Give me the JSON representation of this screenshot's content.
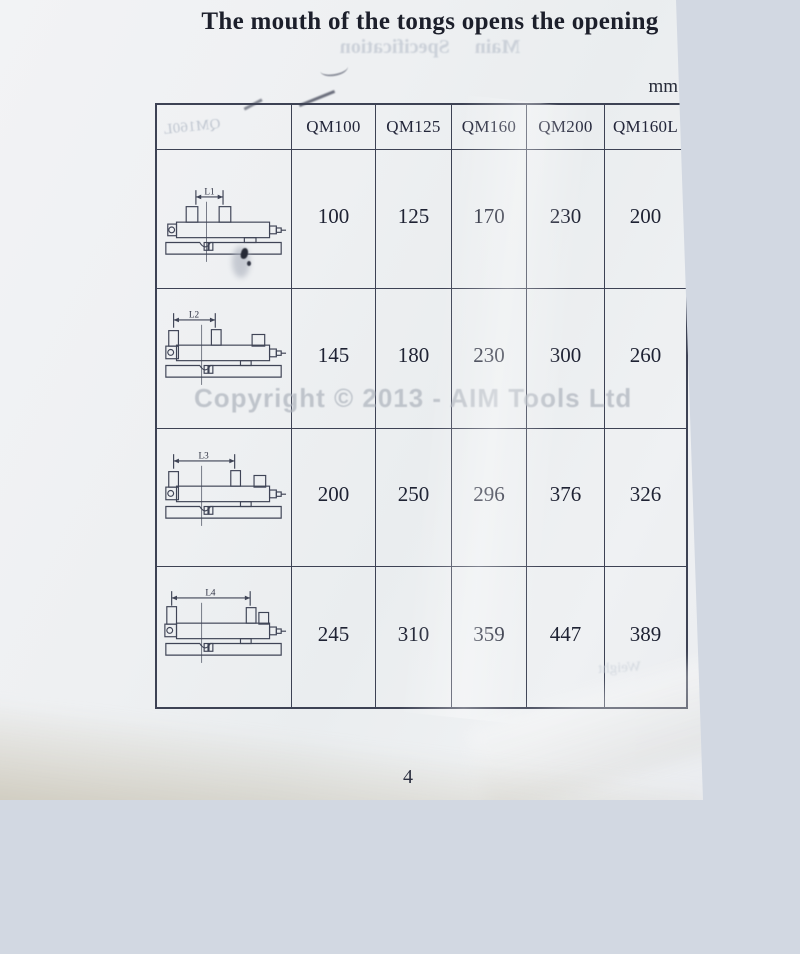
{
  "page": {
    "title": "The mouth of the tongs opens the opening",
    "unit_label": "mm",
    "watermark": "Copyright © 2013 - AIM Tools Ltd",
    "page_number": "4"
  },
  "bleedthrough": {
    "under_title": "Main Specification",
    "header_cell": "QM160L",
    "bottom_right": "Weight"
  },
  "table": {
    "column_headers": [
      "QM100",
      "QM125",
      "QM160",
      "QM200",
      "QM160L"
    ],
    "rows": [
      {
        "diagram_label": "L1",
        "values": [
          "100",
          "125",
          "170",
          "230",
          "200"
        ]
      },
      {
        "diagram_label": "L2",
        "values": [
          "145",
          "180",
          "230",
          "300",
          "260"
        ]
      },
      {
        "diagram_label": "L3",
        "values": [
          "200",
          "250",
          "296",
          "376",
          "326"
        ]
      },
      {
        "diagram_label": "L4",
        "values": [
          "245",
          "310",
          "359",
          "447",
          "389"
        ]
      }
    ]
  },
  "colors": {
    "paper": "#eef0f2",
    "background": "#d2d8e2",
    "table_border": "#3d4254",
    "text": "#1e2233",
    "watermark": "#aeb4bd"
  }
}
